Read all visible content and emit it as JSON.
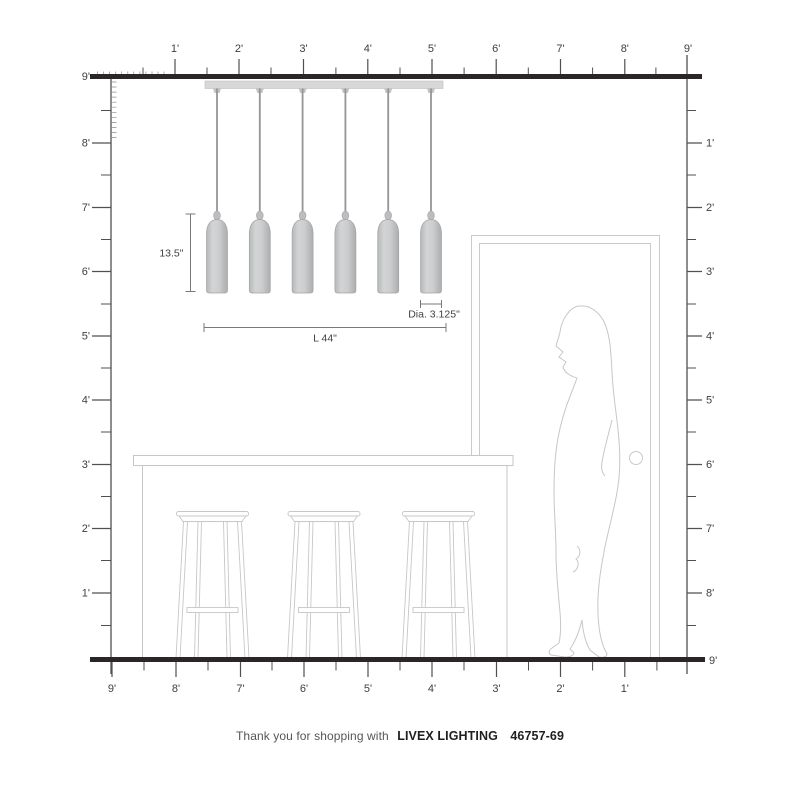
{
  "product": {
    "brand": "LIVEX LIGHTING",
    "model": "46757-69"
  },
  "footer": {
    "prefix": "Thank you for shopping with"
  },
  "annotations": {
    "shade_height": "13.5\"",
    "fixture_length": "L 44\"",
    "shade_diameter": "Dia. 3.125\""
  },
  "rulers": {
    "top": [
      "1'",
      "2'",
      "3'",
      "4'",
      "5'",
      "6'",
      "7'",
      "8'",
      "9'"
    ],
    "left": [
      "9'",
      "8'",
      "7'",
      "6'",
      "5'",
      "4'",
      "3'",
      "2'",
      "1'"
    ],
    "right": [
      "1'",
      "2'",
      "3'",
      "4'",
      "5'",
      "6'",
      "7'",
      "8'",
      "9'"
    ],
    "bottom": [
      "9'",
      "8'",
      "7'",
      "6'",
      "5'",
      "4'",
      "3'",
      "2'",
      "1'"
    ]
  },
  "scene": {
    "pendant_count": 6,
    "stool_count": 3,
    "room_height_feet": 9,
    "room_width_feet": 9
  },
  "colors": {
    "structure_line": "#2a2627",
    "ruler_line": "#4f5052",
    "label_text": "#3f4042",
    "light_outline": "#c7c8ca",
    "shade_gray": "#c9cacb"
  }
}
